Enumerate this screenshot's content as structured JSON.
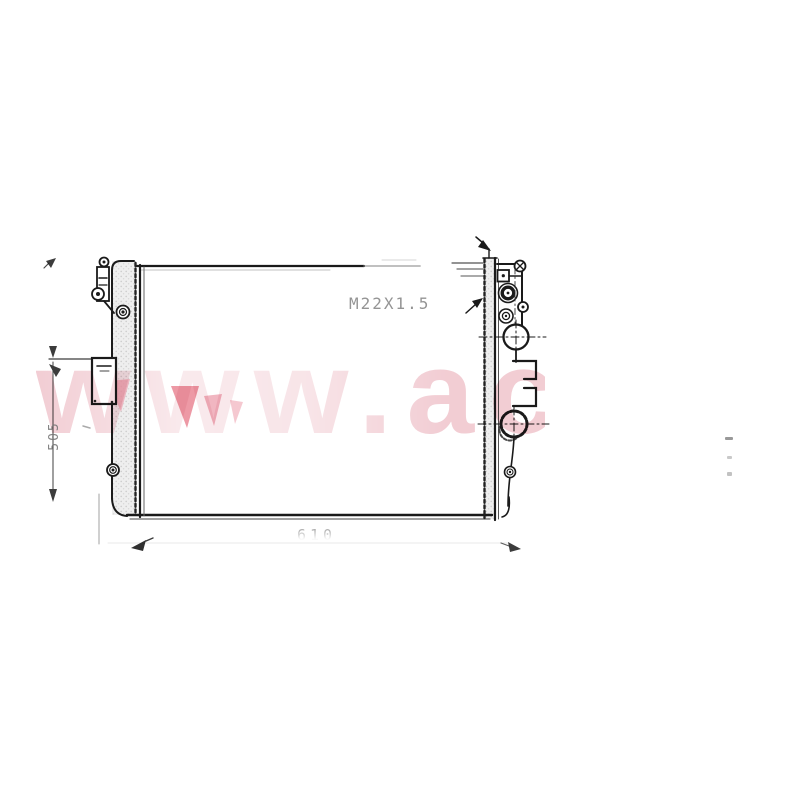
{
  "labels": {
    "thread_spec": "M22X1.5",
    "height_dimension": "505",
    "width_dimension": "610"
  },
  "watermark": {
    "text": "www.ac"
  },
  "colors": {
    "line": "#1a1a1a",
    "faded_line": "#999999",
    "stipple_fill": "#ececec",
    "dimension_text": "#777777",
    "watermark_pink": "#f1cad1",
    "watermark_accent": "#e8808f"
  }
}
